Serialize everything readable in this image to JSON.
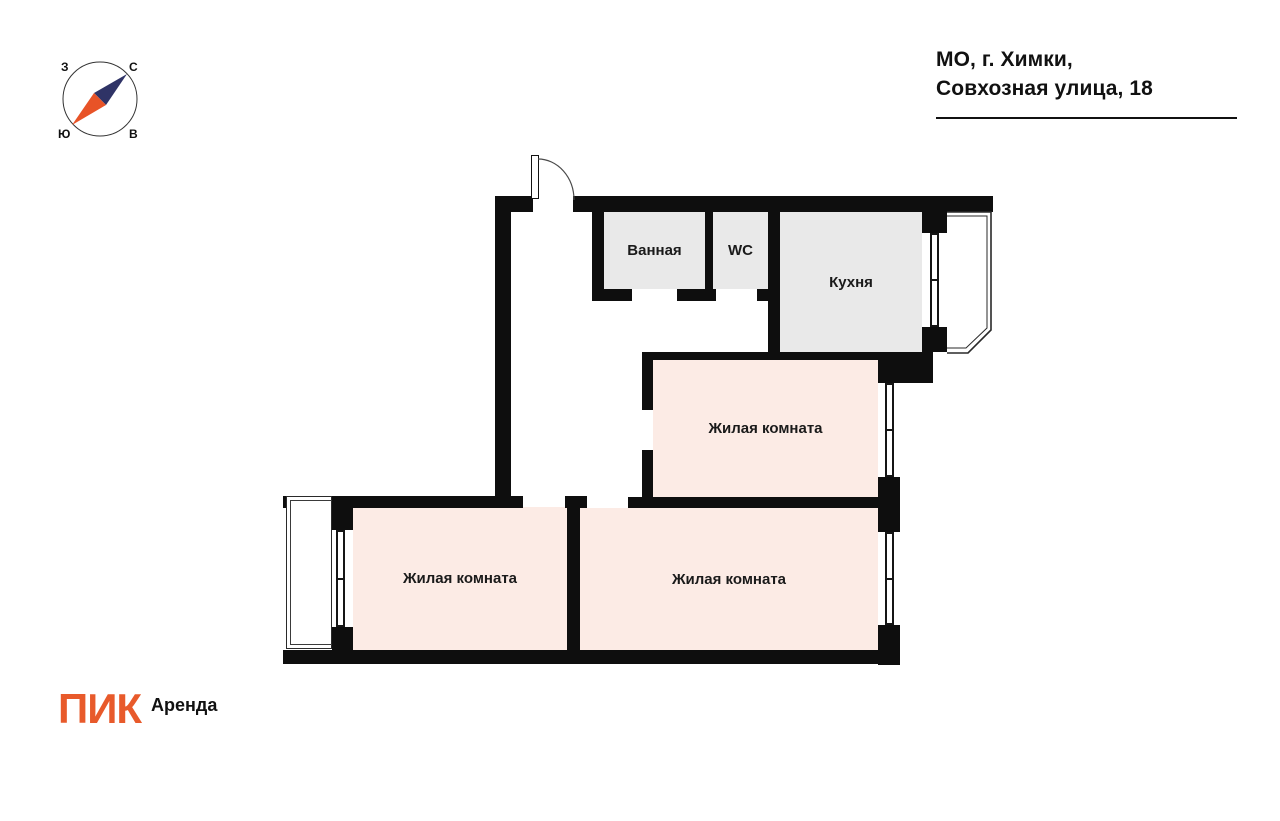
{
  "header": {
    "address_line1": "МО, г. Химки,",
    "address_line2": "Совхозная улица, 18"
  },
  "compass": {
    "labels": {
      "top_left": "З",
      "top_right": "С",
      "bottom_left": "Ю",
      "bottom_right": "В"
    },
    "needle_north_color": "#2f3366",
    "needle_south_color": "#e85327"
  },
  "floorplan": {
    "wall_color": "#0e0e0e",
    "wet_room_fill": "#e9e9e9",
    "living_room_fill": "#fcebe5",
    "rooms": [
      {
        "id": "bathroom",
        "label": "Ванная"
      },
      {
        "id": "wc",
        "label": "WC"
      },
      {
        "id": "kitchen",
        "label": "Кухня"
      },
      {
        "id": "living-room-middle",
        "label": "Жилая комната"
      },
      {
        "id": "living-room-bottom-left",
        "label": "Жилая комната"
      },
      {
        "id": "living-room-bottom-right",
        "label": "Жилая комната"
      }
    ]
  },
  "footer": {
    "brand": "ПИК",
    "brand_color": "#e85a2b",
    "product": "Аренда"
  }
}
